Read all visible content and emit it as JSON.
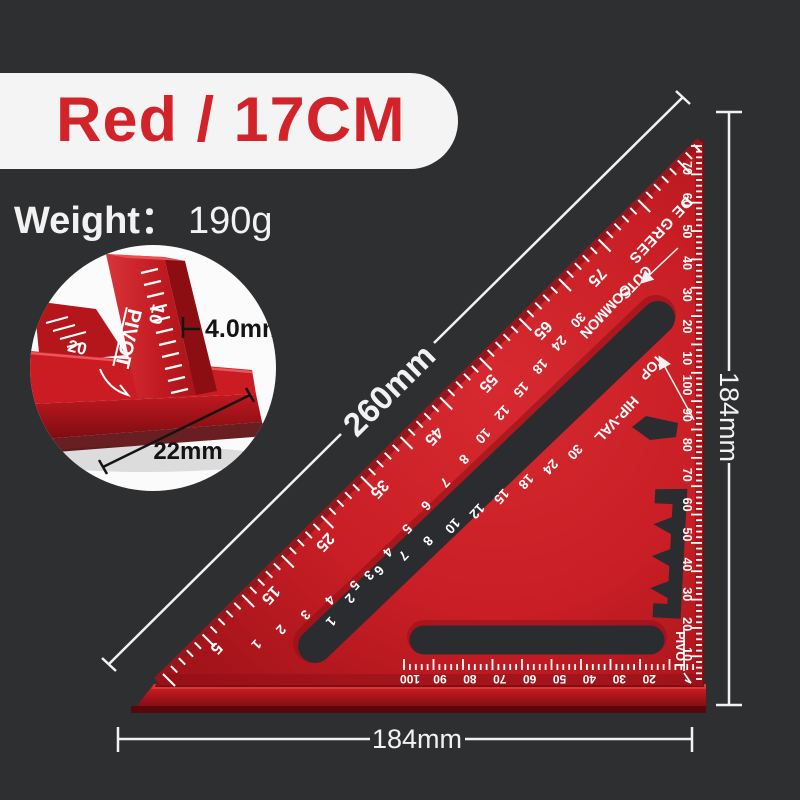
{
  "title": {
    "label": "Red / 17CM"
  },
  "weight": {
    "label": "Weight",
    "colon": "：",
    "value": "190g"
  },
  "dimensions": {
    "hypotenuse": "260mm",
    "right": "184mm",
    "bottom": "184mm"
  },
  "inset": {
    "thickness_label": "4.0mm",
    "width_label": "22mm",
    "pivot_label": "PIVOT",
    "ten": "10",
    "twenty": "20"
  },
  "square": {
    "degrees_label": "DE GREES",
    "cuts_label": "CUTS",
    "common_label": "COMMON",
    "top_label": "TOP",
    "hipval_label": "HIP-VAL",
    "pivot_label": "PIVOT",
    "degree_edge_numbers": [
      "70",
      "60",
      "50",
      "40",
      "30",
      "20",
      "10"
    ],
    "right_mm_numbers": [
      "100",
      "90",
      "80",
      "70",
      "60",
      "50",
      "40",
      "30",
      "20",
      "10"
    ],
    "bottom_mm_numbers": [
      "100",
      "90",
      "80",
      "70",
      "60",
      "50",
      "40",
      "30",
      "20"
    ],
    "hyp_degree_numbers": [
      "75",
      "65",
      "55",
      "45",
      "35",
      "25",
      "15",
      "5"
    ],
    "common_numbers": [
      "30",
      "24",
      "18",
      "15",
      "12",
      "10",
      "8",
      "7",
      "6",
      "5",
      "4",
      "3",
      "2",
      "1"
    ],
    "hipval_numbers": [
      "30",
      "24",
      "18",
      "15",
      "12",
      "10",
      "8",
      "7",
      "6",
      "5",
      "4",
      "3",
      "2",
      "1"
    ]
  },
  "colors": {
    "background": "#2e2f31",
    "banner": "#f4f4f5",
    "accent_red": "#d3232a",
    "square_red": "#c91e25",
    "slot_dark": "#2b2c30",
    "annotation_white": "#f2f2f2",
    "annotation_black": "#141414"
  }
}
